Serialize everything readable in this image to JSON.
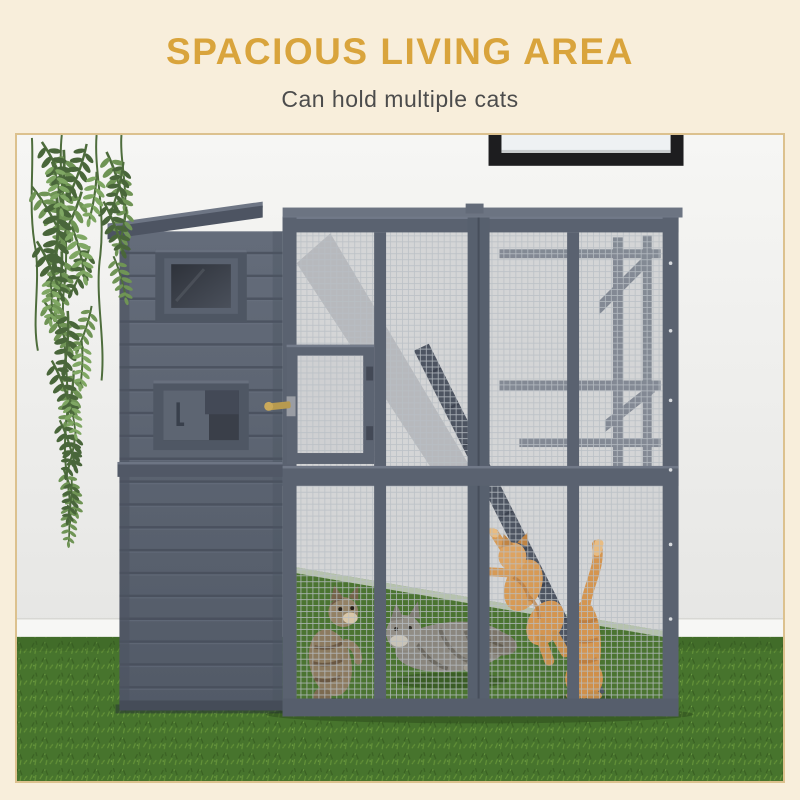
{
  "header": {
    "title": "SPACIOUS LIVING AREA",
    "subtitle": "Can hold multiple cats"
  },
  "colors": {
    "accent_gold": "#D9A43C",
    "cream_background": "#F8EEDB",
    "subtitle_text": "#4C4C4C",
    "photo_border": "#DCC18E",
    "structure_gray": "#5A6270",
    "wall_white": "#F0F0EE",
    "grass_green": "#47742D",
    "orange_cat": "#D49550",
    "gray_cat": "#8A867E",
    "tabby_kitten": "#8C7A5F"
  }
}
